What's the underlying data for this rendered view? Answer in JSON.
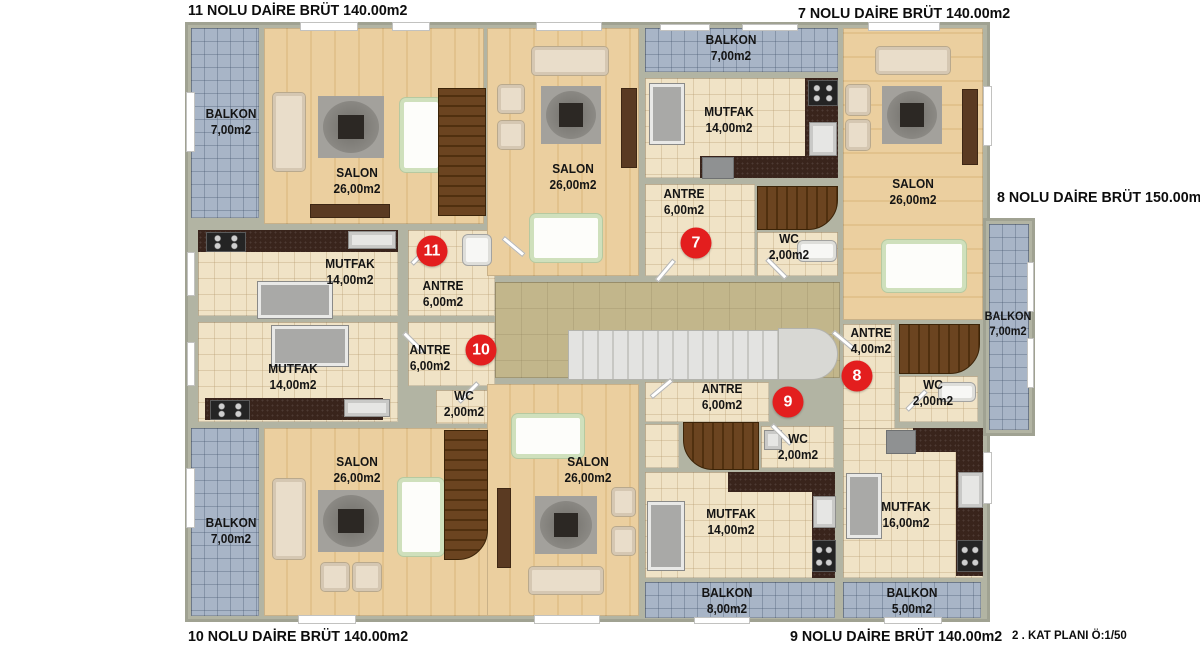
{
  "meta": {
    "plan_note": "2 . KAT PLANI Ö:1/50"
  },
  "apartments": {
    "a11": {
      "title": "11 NOLU DAİRE BRÜT 140.00m2",
      "badge": "11"
    },
    "a7": {
      "title": "7 NOLU DAİRE BRÜT 140.00m2",
      "badge": "7"
    },
    "a8": {
      "title": "8 NOLU DAİRE BRÜT 150.00m2",
      "badge": "8"
    },
    "a10": {
      "title": "10 NOLU DAİRE BRÜT 140.00m2",
      "badge": "10"
    },
    "a9": {
      "title": "9 NOLU DAİRE BRÜT 140.00m2",
      "badge": "9"
    }
  },
  "rooms": {
    "a11_balkon": {
      "name": "BALKON",
      "area": "7,00m2"
    },
    "a11_salon": {
      "name": "SALON",
      "area": "26,00m2"
    },
    "a11_mutfak": {
      "name": "MUTFAK",
      "area": "14,00m2"
    },
    "a11_antre": {
      "name": "ANTRE",
      "area": "6,00m2"
    },
    "a10_mutfak": {
      "name": "MUTFAK",
      "area": "14,00m2"
    },
    "a10_antre": {
      "name": "ANTRE",
      "area": "6,00m2"
    },
    "a10_wc": {
      "name": "WC",
      "area": "2,00m2"
    },
    "a10_salon": {
      "name": "SALON",
      "area": "26,00m2"
    },
    "a10_balkon": {
      "name": "BALKON",
      "area": "7,00m2"
    },
    "a7_balkon": {
      "name": "BALKON",
      "area": "7,00m2"
    },
    "a7_mutfak": {
      "name": "MUTFAK",
      "area": "14,00m2"
    },
    "a7_antre": {
      "name": "ANTRE",
      "area": "6,00m2"
    },
    "a7_wc": {
      "name": "WC",
      "area": "2,00m2"
    },
    "a7_salon": {
      "name": "SALON",
      "area": "26,00m2"
    },
    "a8_salon": {
      "name": "SALON",
      "area": "26,00m2"
    },
    "a8_antre": {
      "name": "ANTRE",
      "area": "4,00m2"
    },
    "a8_wc": {
      "name": "WC",
      "area": "2,00m2"
    },
    "a8_mutfak": {
      "name": "MUTFAK",
      "area": "16,00m2"
    },
    "a8_balkon_side": {
      "name": "BALKON",
      "area": "7,00m2"
    },
    "a8_balkon_rear": {
      "name": "BALKON",
      "area": "5,00m2"
    },
    "a9_salon": {
      "name": "SALON",
      "area": "26,00m2"
    },
    "a9_antre": {
      "name": "ANTRE",
      "area": "6,00m2"
    },
    "a9_wc": {
      "name": "WC",
      "area": "2,00m2"
    },
    "a9_mutfak": {
      "name": "MUTFAK",
      "area": "14,00m2"
    },
    "a9_balkon": {
      "name": "BALKON",
      "area": "8,00m2"
    }
  },
  "colors": {
    "badge_red": "#e31e1e",
    "balcony_tile": "#a8b5c7",
    "ceramic_floor": "#f0e3c6",
    "wood_floor": "#e7c996",
    "hall_floor": "#c2b68b",
    "wall": "#b2b4a3",
    "counter_dark": "#39241c",
    "stair_wood": "#6b4420"
  }
}
